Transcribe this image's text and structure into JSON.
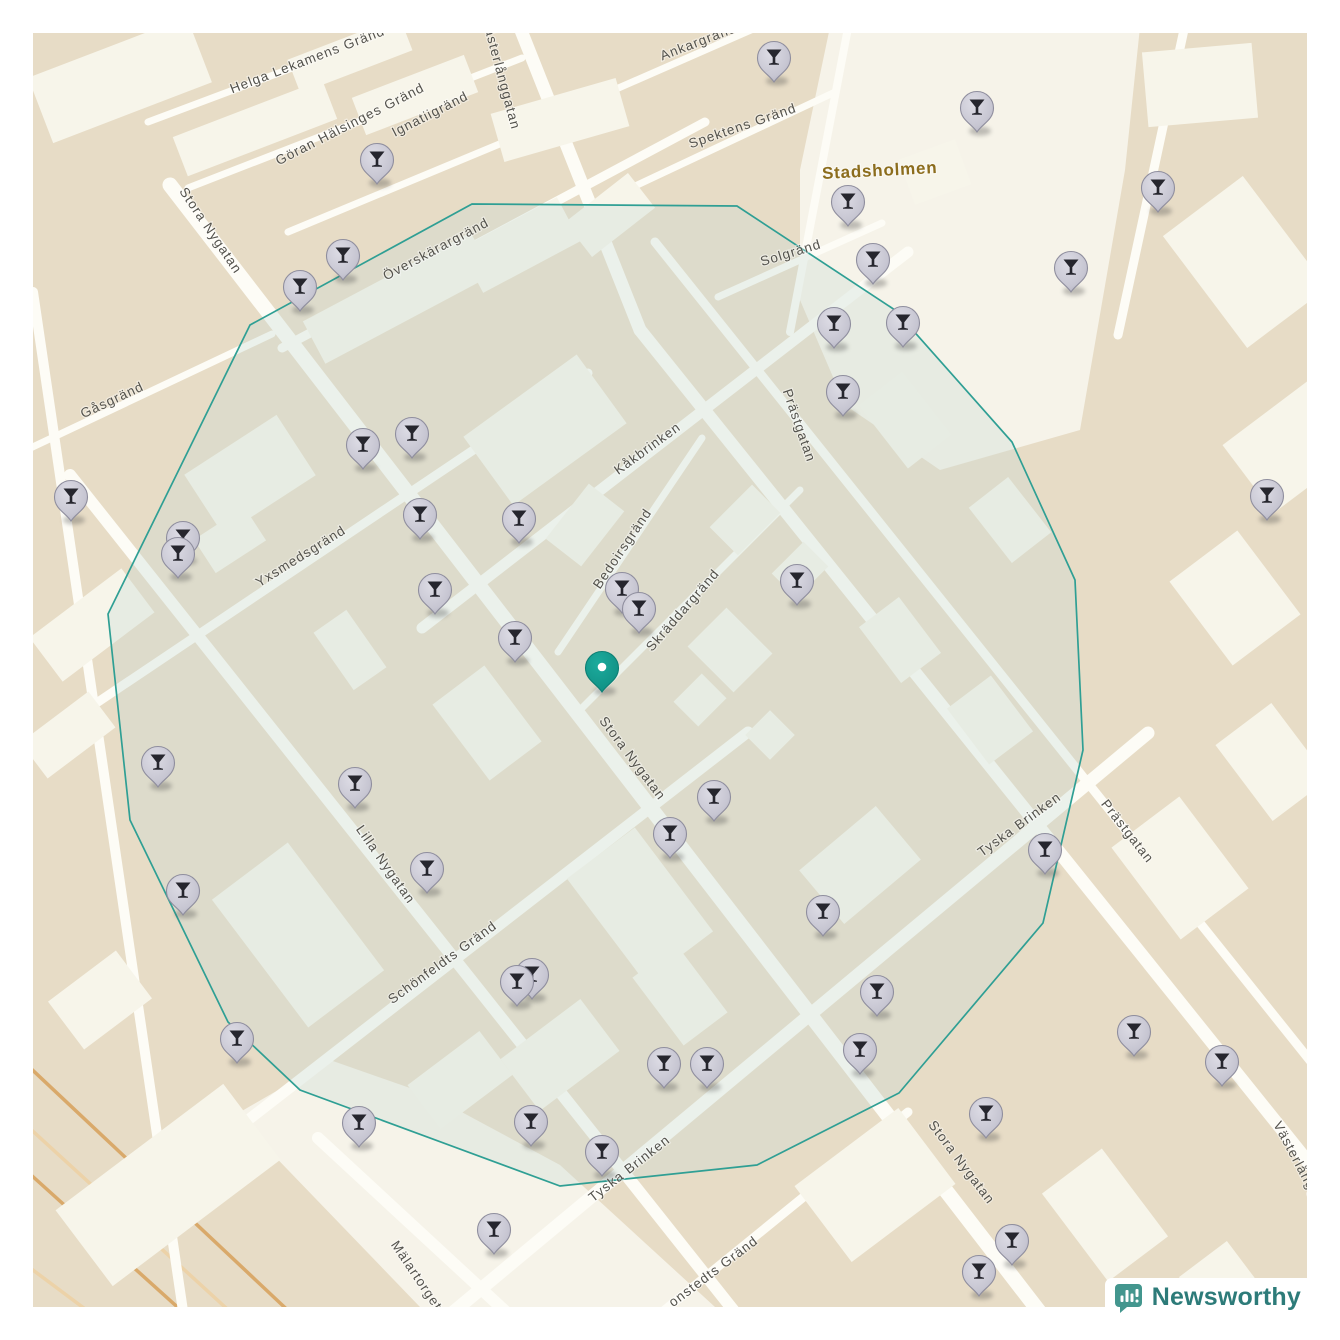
{
  "attribution": {
    "label": "Newsworthy",
    "icon": "newsworthy-logo",
    "text_color": "#2d7b79",
    "icon_color": "#43968e"
  },
  "map": {
    "size": 1340,
    "margin": 33,
    "colors": {
      "base": "#e7dcc6",
      "building": "#f7f5ea",
      "plaza": "#f6f3e9",
      "street": "#fdfcf6",
      "railway_dark": "#d9a96a",
      "railway_light": "#ecd2a8",
      "label": "#53524c",
      "circle_stroke": "#2f9f94",
      "circle_fill": "rgba(200,220,211,0.33)",
      "pin_head": "#c7c6d2",
      "pin_border": "#8f8e9e",
      "pin_glyph": "#26262e",
      "center_pin": "#13a295",
      "area_label_color": "#8c6d1d"
    },
    "area_label": {
      "text": "Stadsholmen",
      "x": 880,
      "y": 176,
      "rot": -3,
      "size": 17,
      "color": "#8c6d1d"
    },
    "street_labels": [
      {
        "text": "Helga Lekamens Gränd",
        "x": 309,
        "y": 64,
        "rot": -21
      },
      {
        "text": "Göran Hälsinges Gränd",
        "x": 352,
        "y": 128,
        "rot": -27
      },
      {
        "text": "Ignatiigränd",
        "x": 432,
        "y": 118,
        "rot": -27
      },
      {
        "text": "Ankargränd",
        "x": 700,
        "y": 46,
        "rot": -21
      },
      {
        "text": "Spektens Gränd",
        "x": 744,
        "y": 130,
        "rot": -19
      },
      {
        "text": "Solgränd",
        "x": 792,
        "y": 257,
        "rot": -17
      },
      {
        "text": "Stora Nygatan",
        "x": 207,
        "y": 233,
        "rot": 56
      },
      {
        "text": "Västerlånggatan",
        "x": 497,
        "y": 75,
        "rot": 75
      },
      {
        "text": "Överskärargränd",
        "x": 438,
        "y": 253,
        "rot": -28
      },
      {
        "text": "Gåsgränd",
        "x": 114,
        "y": 404,
        "rot": -25
      },
      {
        "text": "Yxsmedsgränd",
        "x": 303,
        "y": 560,
        "rot": -32
      },
      {
        "text": "Kåkbrinken",
        "x": 650,
        "y": 452,
        "rot": -36
      },
      {
        "text": "Prästgatan",
        "x": 795,
        "y": 427,
        "rot": 71
      },
      {
        "text": "Bedoirsgränd",
        "x": 626,
        "y": 551,
        "rot": -56
      },
      {
        "text": "Skräddargränd",
        "x": 686,
        "y": 613,
        "rot": -49
      },
      {
        "text": "Stora Nygatan",
        "x": 629,
        "y": 761,
        "rot": 53
      },
      {
        "text": "Lilla Nygatan",
        "x": 382,
        "y": 867,
        "rot": 55
      },
      {
        "text": "Schönfeldts Gränd",
        "x": 445,
        "y": 966,
        "rot": -36
      },
      {
        "text": "Tyska Brinken",
        "x": 632,
        "y": 1172,
        "rot": -38
      },
      {
        "text": "Tyska Brinken",
        "x": 1022,
        "y": 828,
        "rot": -36
      },
      {
        "text": "Prästgatan",
        "x": 1124,
        "y": 834,
        "rot": 52
      },
      {
        "text": "Stora Nygatan",
        "x": 958,
        "y": 1165,
        "rot": 53
      },
      {
        "text": "Västerlånggatan",
        "x": 1300,
        "y": 1175,
        "rot": 62
      },
      {
        "text": "Mälartorget",
        "x": 413,
        "y": 1278,
        "rot": 56
      },
      {
        "text": "onstedts Gränd",
        "x": 716,
        "y": 1275,
        "rot": -37
      }
    ],
    "streets": [
      [
        497,
        -30,
        640,
        330,
        13
      ],
      [
        640,
        330,
        1345,
        1208,
        13
      ],
      [
        170,
        185,
        1065,
        1345,
        15
      ],
      [
        70,
        475,
        765,
        1350,
        12
      ],
      [
        655,
        242,
        1348,
        1108,
        9
      ],
      [
        410,
        1348,
        1148,
        733,
        13
      ],
      [
        422,
        628,
        908,
        252,
        11
      ],
      [
        212,
        1148,
        748,
        732,
        11
      ],
      [
        98,
        702,
        588,
        373,
        9
      ],
      [
        282,
        348,
        705,
        122,
        9
      ],
      [
        22,
        452,
        272,
        334,
        7
      ],
      [
        148,
        122,
        425,
        18,
        7
      ],
      [
        188,
        188,
        522,
        58,
        7
      ],
      [
        288,
        232,
        562,
        118,
        7
      ],
      [
        598,
        97,
        792,
        12,
        7
      ],
      [
        633,
        187,
        833,
        93,
        7
      ],
      [
        718,
        297,
        882,
        223,
        7
      ],
      [
        558,
        652,
        702,
        438,
        7
      ],
      [
        580,
        710,
        800,
        490,
        7
      ],
      [
        318,
        1138,
        545,
        1348,
        12
      ],
      [
        618,
        1348,
        908,
        1112,
        9
      ],
      [
        33,
        292,
        188,
        1345,
        10
      ],
      [
        848,
        28,
        790,
        332,
        8
      ],
      [
        1185,
        25,
        1118,
        335,
        9
      ]
    ],
    "railways": [
      [
        -10,
        1030,
        330,
        1350
      ],
      [
        -10,
        1092,
        272,
        1350
      ],
      [
        20,
        1165,
        225,
        1350
      ],
      [
        -10,
        1238,
        140,
        1350
      ]
    ],
    "plazas": [
      [
        [
          830,
          27
        ],
        [
          1140,
          27
        ],
        [
          1125,
          170
        ],
        [
          1080,
          430
        ],
        [
          940,
          470
        ],
        [
          845,
          405
        ],
        [
          800,
          300
        ],
        [
          800,
          170
        ]
      ],
      [
        [
          235,
          1115
        ],
        [
          420,
          1307
        ],
        [
          715,
          1307
        ],
        [
          560,
          1165
        ],
        [
          430,
          1095
        ],
        [
          330,
          1060
        ]
      ]
    ],
    "buildings": [
      [
        120,
        80,
        170,
        70,
        -21
      ],
      [
        255,
        128,
        160,
        42,
        -21
      ],
      [
        415,
        95,
        120,
        40,
        -21
      ],
      [
        350,
        55,
        120,
        36,
        -21
      ],
      [
        560,
        120,
        50,
        130,
        74
      ],
      [
        610,
        215,
        44,
        80,
        52
      ],
      [
        398,
        298,
        190,
        48,
        -28
      ],
      [
        520,
        245,
        110,
        50,
        -28
      ],
      [
        250,
        475,
        110,
        72,
        -33
      ],
      [
        230,
        540,
        60,
        40,
        -33
      ],
      [
        350,
        650,
        70,
        40,
        55
      ],
      [
        545,
        430,
        140,
        85,
        -36
      ],
      [
        585,
        525,
        70,
        45,
        -52
      ],
      [
        730,
        650,
        55,
        65,
        -45
      ],
      [
        700,
        700,
        40,
        35,
        -45
      ],
      [
        770,
        735,
        35,
        35,
        -45
      ],
      [
        860,
        865,
        100,
        70,
        -40
      ],
      [
        640,
        905,
        130,
        85,
        53
      ],
      [
        487,
        723,
        95,
        65,
        53
      ],
      [
        298,
        935,
        160,
        95,
        53
      ],
      [
        460,
        1080,
        90,
        55,
        -37
      ],
      [
        560,
        1055,
        100,
        65,
        -37
      ],
      [
        680,
        995,
        55,
        85,
        -37
      ],
      [
        875,
        1185,
        130,
        95,
        -37
      ],
      [
        1105,
        1215,
        110,
        75,
        53
      ],
      [
        1230,
        1295,
        90,
        60,
        53
      ],
      [
        1180,
        868,
        115,
        85,
        53
      ],
      [
        1272,
        762,
        95,
        70,
        53
      ],
      [
        1235,
        598,
        105,
        85,
        53
      ],
      [
        1300,
        440,
        85,
        130,
        53
      ],
      [
        1245,
        262,
        140,
        100,
        53
      ],
      [
        1200,
        85,
        110,
        75,
        -5
      ],
      [
        935,
        172,
        60,
        48,
        -20
      ],
      [
        92,
        625,
        55,
        115,
        53
      ],
      [
        68,
        735,
        45,
        85,
        53
      ],
      [
        100,
        1000,
        60,
        85,
        53
      ],
      [
        168,
        1185,
        95,
        210,
        53
      ],
      [
        745,
        520,
        60,
        40,
        -45
      ],
      [
        800,
        570,
        45,
        35,
        -45
      ],
      [
        900,
        640,
        70,
        50,
        53
      ],
      [
        990,
        720,
        70,
        55,
        53
      ],
      [
        905,
        420,
        80,
        55,
        52
      ],
      [
        1010,
        520,
        70,
        50,
        52
      ]
    ],
    "circle": {
      "points": [
        [
          472,
          204
        ],
        [
          737,
          206
        ],
        [
          895,
          310
        ],
        [
          1012,
          442
        ],
        [
          1075,
          580
        ],
        [
          1083,
          750
        ],
        [
          1043,
          923
        ],
        [
          899,
          1093
        ],
        [
          757,
          1165
        ],
        [
          560,
          1186
        ],
        [
          300,
          1090
        ],
        [
          228,
          1022
        ],
        [
          130,
          820
        ],
        [
          108,
          614
        ],
        [
          250,
          325
        ]
      ]
    },
    "pins": [
      [
        774,
        58
      ],
      [
        977,
        108
      ],
      [
        1158,
        188
      ],
      [
        377,
        160
      ],
      [
        848,
        202
      ],
      [
        873,
        260
      ],
      [
        1071,
        268
      ],
      [
        343,
        256
      ],
      [
        300,
        287
      ],
      [
        834,
        324
      ],
      [
        903,
        323
      ],
      [
        843,
        392
      ],
      [
        363,
        445
      ],
      [
        412,
        434
      ],
      [
        1267,
        496
      ],
      [
        71,
        497
      ],
      [
        183,
        538
      ],
      [
        178,
        554
      ],
      [
        420,
        515
      ],
      [
        519,
        519
      ],
      [
        435,
        590
      ],
      [
        622,
        589
      ],
      [
        639,
        609
      ],
      [
        797,
        581
      ],
      [
        515,
        638
      ],
      [
        158,
        763
      ],
      [
        355,
        784
      ],
      [
        714,
        797
      ],
      [
        670,
        834
      ],
      [
        427,
        869
      ],
      [
        183,
        891
      ],
      [
        1045,
        850
      ],
      [
        823,
        912
      ],
      [
        877,
        992
      ],
      [
        517,
        982
      ],
      [
        532,
        975
      ],
      [
        237,
        1039
      ],
      [
        860,
        1050
      ],
      [
        1134,
        1032
      ],
      [
        1222,
        1062
      ],
      [
        664,
        1064
      ],
      [
        707,
        1064
      ],
      [
        359,
        1123
      ],
      [
        531,
        1122
      ],
      [
        986,
        1114
      ],
      [
        602,
        1152
      ],
      [
        494,
        1230
      ],
      [
        1012,
        1241
      ],
      [
        979,
        1272
      ]
    ],
    "center_pin": [
      602,
      668
    ]
  }
}
